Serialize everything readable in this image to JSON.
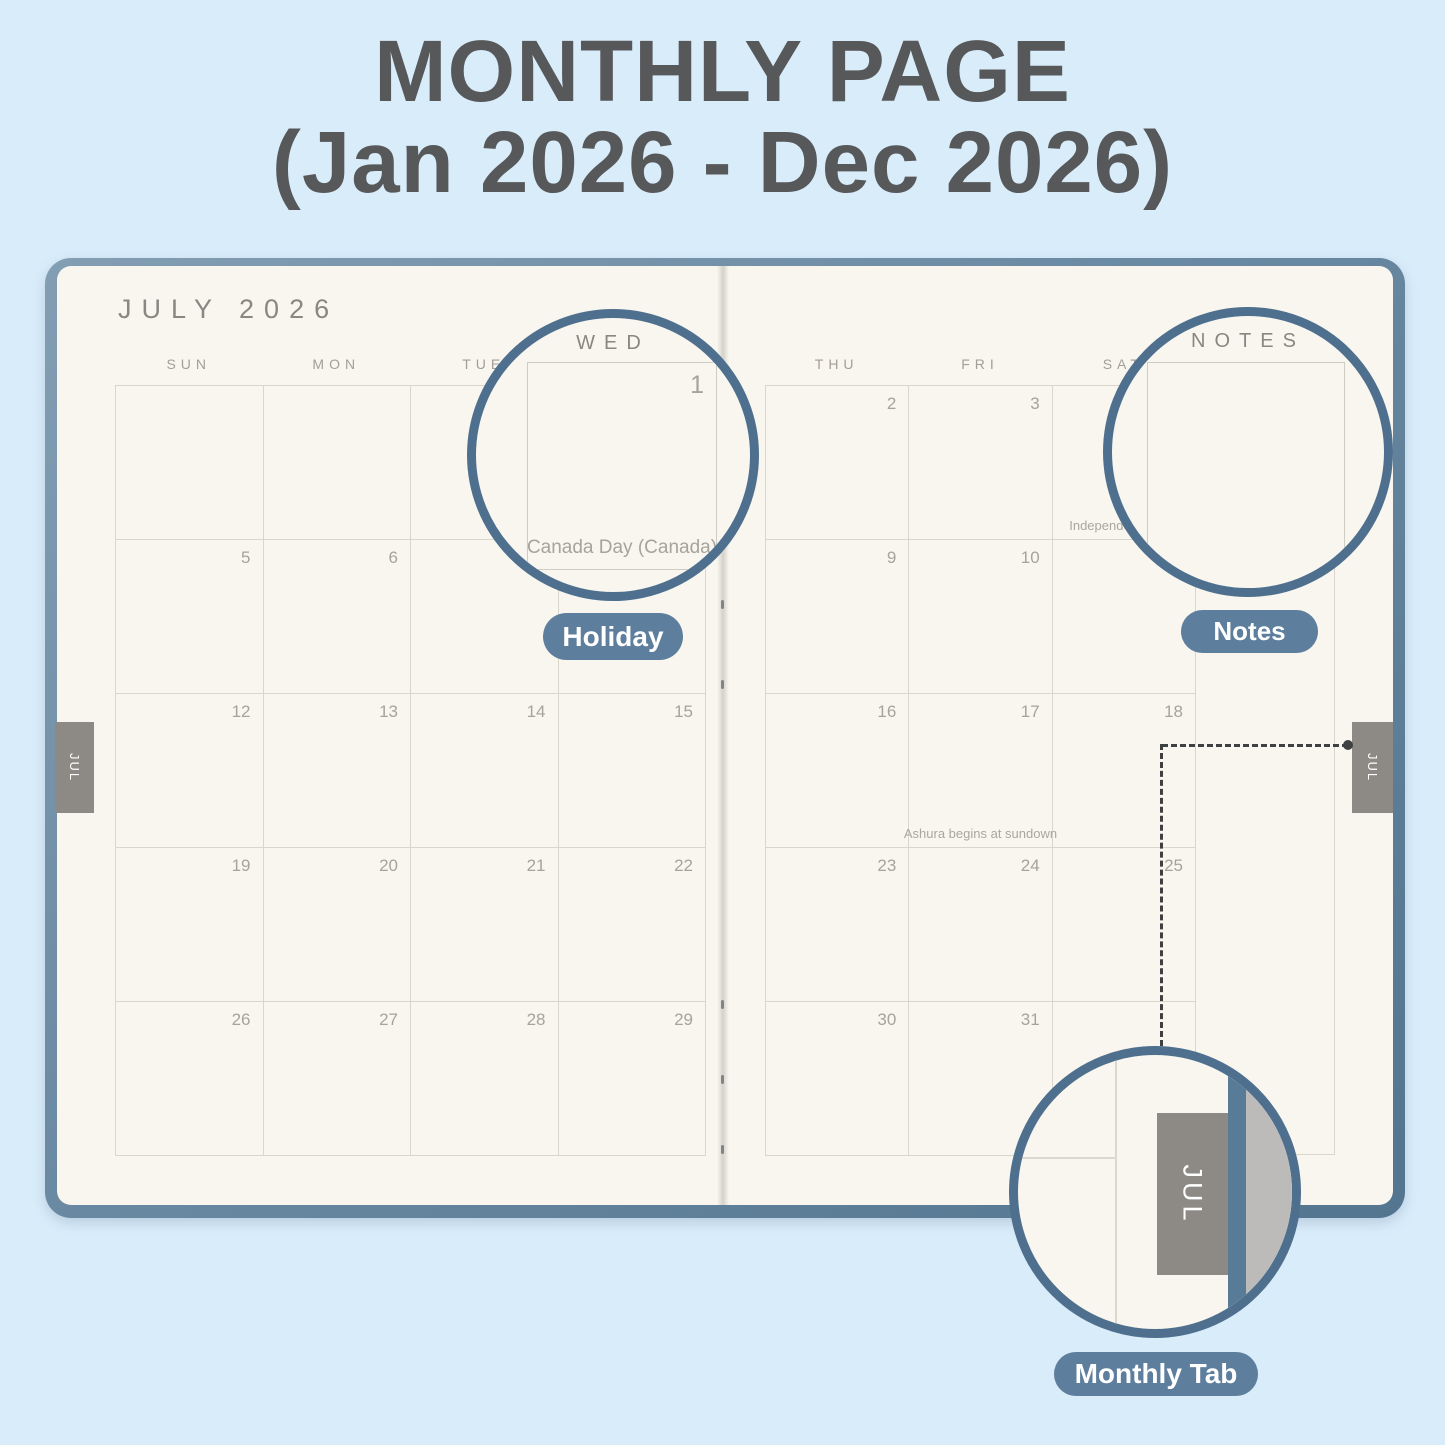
{
  "title": {
    "line1": "MONTHLY PAGE",
    "line2": "(Jan 2026 - Dec 2026)"
  },
  "planner": {
    "month_title": "JULY 2026",
    "left_day_headers": [
      "SUN",
      "MON",
      "TUE",
      "WED"
    ],
    "right_day_headers": [
      "THU",
      "FRI",
      "SAT"
    ],
    "notes_header": "NOTES",
    "weeks_left": [
      [
        "",
        "",
        "",
        "1"
      ],
      [
        "5",
        "6",
        "7",
        "8"
      ],
      [
        "12",
        "13",
        "14",
        "15"
      ],
      [
        "19",
        "20",
        "21",
        "22"
      ],
      [
        "26",
        "27",
        "28",
        "29"
      ]
    ],
    "weeks_right": [
      [
        "2",
        "3",
        "4"
      ],
      [
        "9",
        "10",
        "11"
      ],
      [
        "16",
        "17",
        "18"
      ],
      [
        "23",
        "24",
        "25"
      ],
      [
        "30",
        "31",
        ""
      ]
    ],
    "holidays": [
      {
        "date": "1",
        "label": "Canada Day (Canada)"
      },
      {
        "date": "4",
        "label": "Independence Day"
      },
      {
        "date": "17",
        "label": "Ashura begins at sundown"
      }
    ],
    "tab_label": "JUL"
  },
  "callouts": {
    "holiday_badge": "Holiday",
    "notes_badge": "Notes",
    "monthly_tab_badge": "Monthly Tab",
    "magnified_wed": {
      "header": "WED",
      "date": "1",
      "holiday": "Canada Day (Canada)"
    },
    "magnified_notes": {
      "header": "NOTES"
    },
    "magnified_tab": {
      "label": "JUL"
    }
  },
  "colors": {
    "background": "#d9ecfa",
    "title_text": "#57585a",
    "cover_blue": "#6a89a2",
    "page_cream": "#f8f6ef",
    "grid_line": "#d9d6cc",
    "date_text": "#a6a39b",
    "tab_gray": "#8d8a86",
    "badge_blue": "#5d7e9c",
    "circle_border": "#4e708e"
  }
}
